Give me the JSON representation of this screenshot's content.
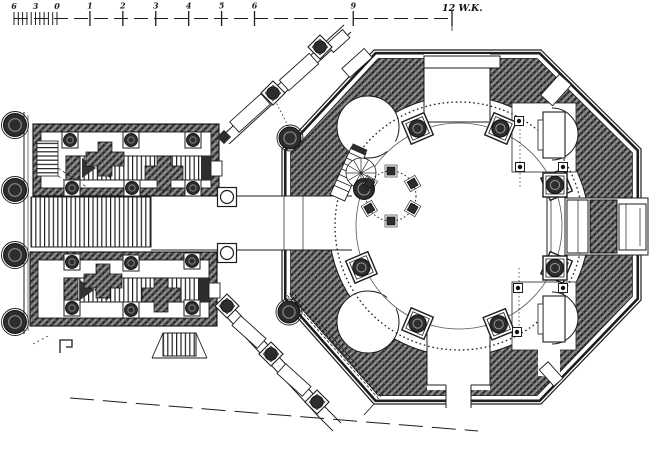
{
  "figure": {
    "type": "engraved architectural floor plan",
    "description": "Octagonal domed hall with inner ring of columns, east ark, corner niches, connected rectangular annex wing with stairs and benches",
    "canvas": {
      "w": 650,
      "h": 458
    }
  },
  "colors": {
    "paper": "#ffffff",
    "ink": "#1d1d1d",
    "hatch_base": "#8f8f8f",
    "hatch_line": "#2c2c2c",
    "column_dark": "#2d2d2d",
    "light_line": "#555555"
  },
  "scale_bar": {
    "subdivision_labels": [
      "6",
      "3",
      "0"
    ],
    "unit_labels": [
      "1",
      "2",
      "3",
      "4",
      "5",
      "6",
      "9"
    ],
    "unit_values": [
      1,
      2,
      3,
      4,
      5,
      6,
      9
    ],
    "tick_values": [
      1,
      2,
      3,
      4,
      5,
      6,
      9,
      12
    ],
    "end_label": "12 W.K.",
    "geometry": {
      "x_start": 14,
      "x_zero": 57,
      "x_unit12": 452,
      "y": 18,
      "units": 12,
      "subdivisions": 10
    }
  },
  "rotunda": {
    "center": {
      "x": 459,
      "y": 226
    },
    "dome_circle_r": 124,
    "floor_circle_r": 103,
    "column_ring_r": 106,
    "ring_column_angles_deg": [
      247,
      293,
      337,
      23,
      68,
      113,
      157
    ],
    "ring_column_size": 24,
    "ark_columns": [
      {
        "x": 555,
        "y": 185
      },
      {
        "x": 555,
        "y": 268
      }
    ],
    "bimah": {
      "cx": 391,
      "cy": 196,
      "r": 25,
      "post_angles_deg": [
        270,
        330,
        30,
        90,
        150,
        210
      ],
      "post_size": 8
    },
    "niche_posts": [
      {
        "x": 519,
        "y": 121
      },
      {
        "x": 520,
        "y": 167
      },
      {
        "x": 563,
        "y": 167
      },
      {
        "x": 518,
        "y": 288
      },
      {
        "x": 517,
        "y": 332
      },
      {
        "x": 563,
        "y": 288
      }
    ]
  },
  "annex": {
    "hall_columns": [
      {
        "x": 70,
        "y": 140
      },
      {
        "x": 131,
        "y": 140
      },
      {
        "x": 193,
        "y": 140
      },
      {
        "x": 72,
        "y": 188
      },
      {
        "x": 132,
        "y": 188
      },
      {
        "x": 193,
        "y": 188
      },
      {
        "x": 72,
        "y": 262
      },
      {
        "x": 131,
        "y": 263
      },
      {
        "x": 192,
        "y": 261
      },
      {
        "x": 72,
        "y": 308
      },
      {
        "x": 131,
        "y": 310
      },
      {
        "x": 192,
        "y": 308
      }
    ],
    "free_columns": [
      {
        "x": 227,
        "y": 197
      },
      {
        "x": 227,
        "y": 253
      }
    ],
    "portico_columns": {
      "x": 15,
      "ys": [
        125,
        190,
        255,
        322
      ],
      "r": 11.5
    }
  },
  "galleries": {
    "nw_columns": [
      {
        "x": 320,
        "y": 47
      },
      {
        "x": 273,
        "y": 93
      }
    ],
    "sw_columns": [
      {
        "x": 227,
        "y": 306
      },
      {
        "x": 271,
        "y": 354
      },
      {
        "x": 317,
        "y": 402
      }
    ],
    "corner_columns": [
      {
        "x": 290,
        "y": 138
      },
      {
        "x": 289,
        "y": 312
      }
    ]
  }
}
